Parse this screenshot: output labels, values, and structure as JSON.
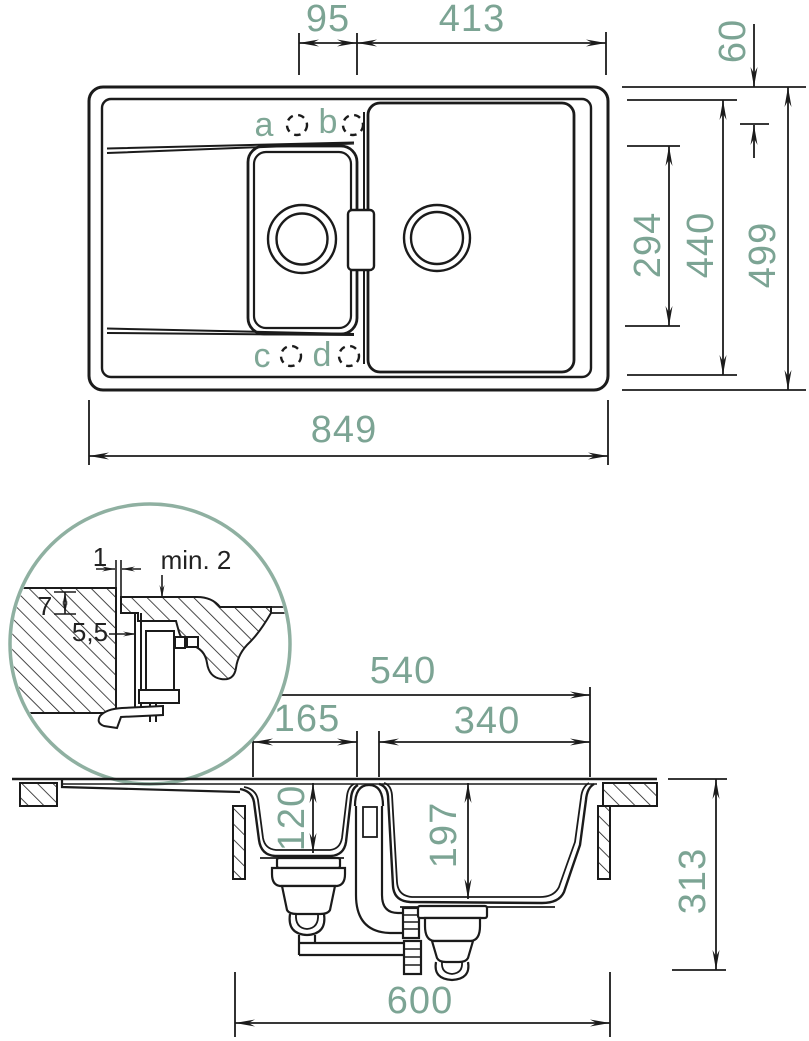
{
  "drawing": {
    "type": "sink technical drawing",
    "views": [
      "top view",
      "mounting detail",
      "cross section"
    ]
  },
  "colors": {
    "line": "#1b1b1b",
    "dim_text_green": "#7CA494",
    "hole_label_green": "#7FA796",
    "detail_circle_green": "#8FB0A1",
    "background": "#ffffff"
  },
  "top_view": {
    "hole_labels": {
      "a": "a",
      "b": "b",
      "c": "c",
      "d": "d"
    },
    "dims": {
      "hole_spacing": "95",
      "bowl_to_edge": "413",
      "rim_offset": "60",
      "small_bowl_length": "294",
      "bowl_span_depth": "440",
      "total_depth": "499",
      "total_length": "849"
    }
  },
  "detail_view": {
    "dims": {
      "gap": "1",
      "overhang": "min. 2",
      "rim_height": "7",
      "reveal": "5,5"
    }
  },
  "section_view": {
    "dims": {
      "bowl_span": "540",
      "small_bowl_width": "165",
      "large_bowl_width": "340",
      "small_bowl_depth": "120",
      "large_bowl_depth": "197",
      "total_height": "313",
      "cabinet_width": "600"
    }
  }
}
